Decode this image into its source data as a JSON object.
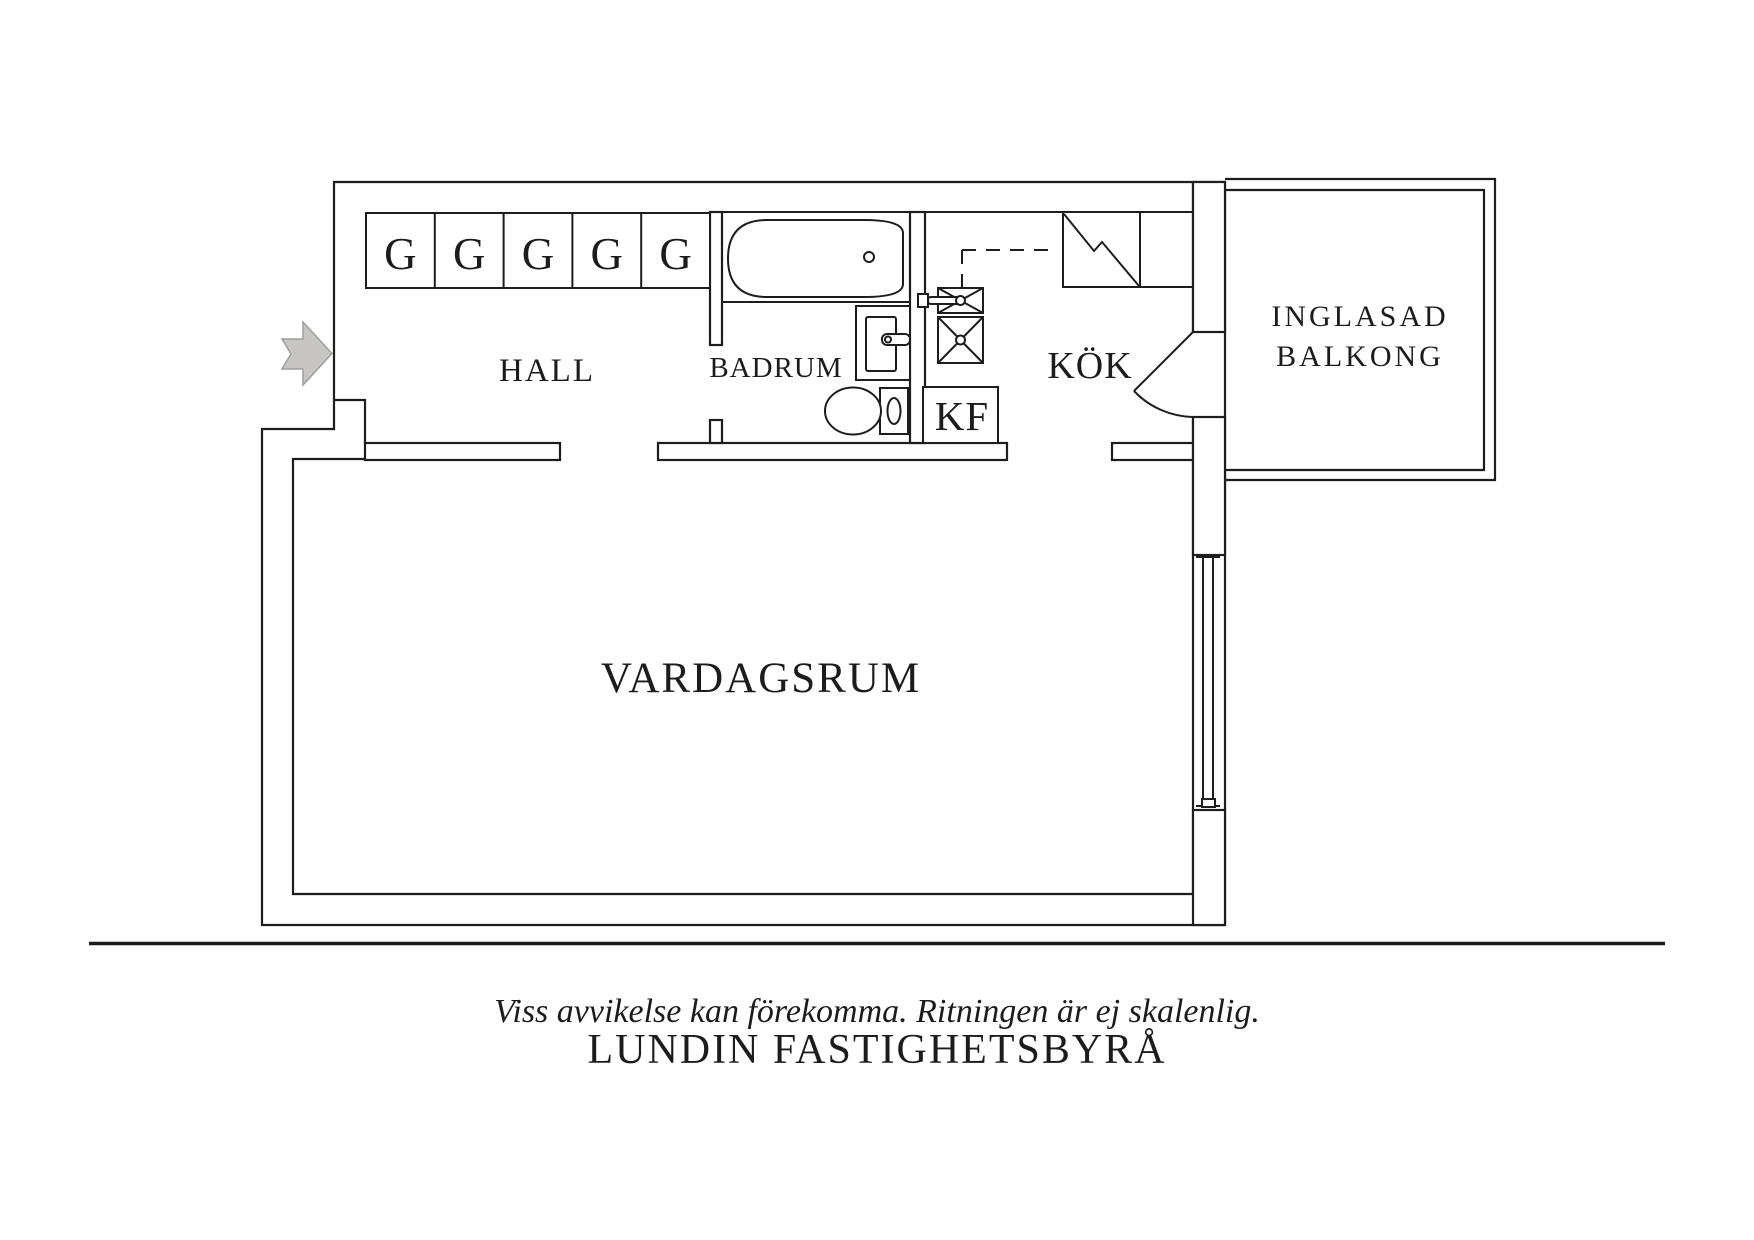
{
  "page": {
    "background": "#ffffff"
  },
  "floorplan": {
    "labels": {
      "closet": "G",
      "hall": "HALL",
      "badrum": "BADRUM",
      "kok": "KÖK",
      "kf": "KF",
      "vardagsrum": "VARDAGSRUM",
      "balkong_line1": "INGLASAD",
      "balkong_line2": "BALKONG"
    },
    "closet_count": 5,
    "fixtures": [
      "entrance-arrow",
      "wardrobe-cabinets",
      "bathtub",
      "washbasin",
      "toilet",
      "kitchen-sink",
      "stove",
      "fridge-freezer",
      "balcony-door",
      "window"
    ],
    "colors": {
      "wall_line": "#1d1d1d",
      "text": "#1c1c1c",
      "arrow_fill": "#c7c6c4",
      "arrow_stroke": "#9e9e9c",
      "background": "#ffffff"
    }
  },
  "footer": {
    "disclaimer": "Viss avvikelse kan förekomma. Ritningen är ej skalenlig.",
    "company": "LUNDIN FASTIGHETSBYRÅ"
  }
}
